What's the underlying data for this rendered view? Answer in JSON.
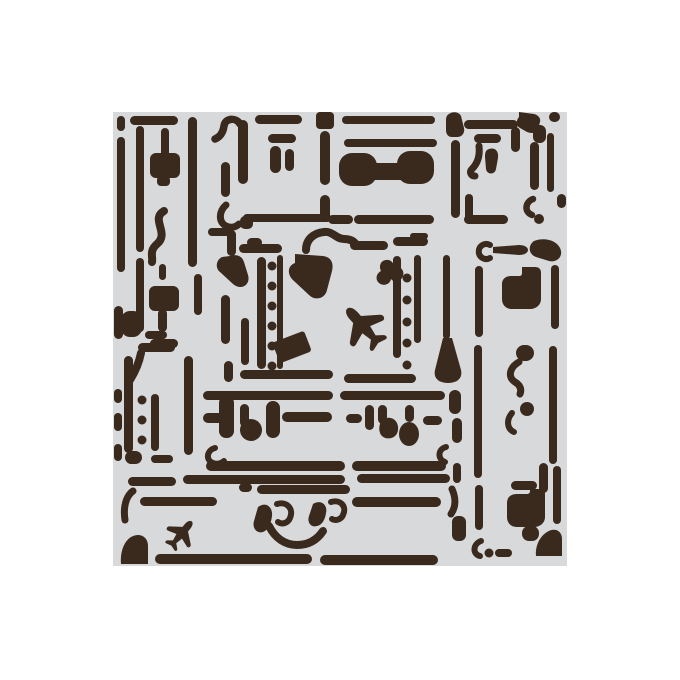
{
  "image": {
    "alt": "Luggage stencil pattern — stacked vintage suitcases and travel trunks with straps, rivets, handles, latches and small airplanes, drawn as a dark brown stencil cut on a light gray square sheet over a white background"
  },
  "colors": {
    "background": "#ffffff",
    "stencil_sheet": "#d8d9da",
    "ink": "#3a2a1d"
  }
}
